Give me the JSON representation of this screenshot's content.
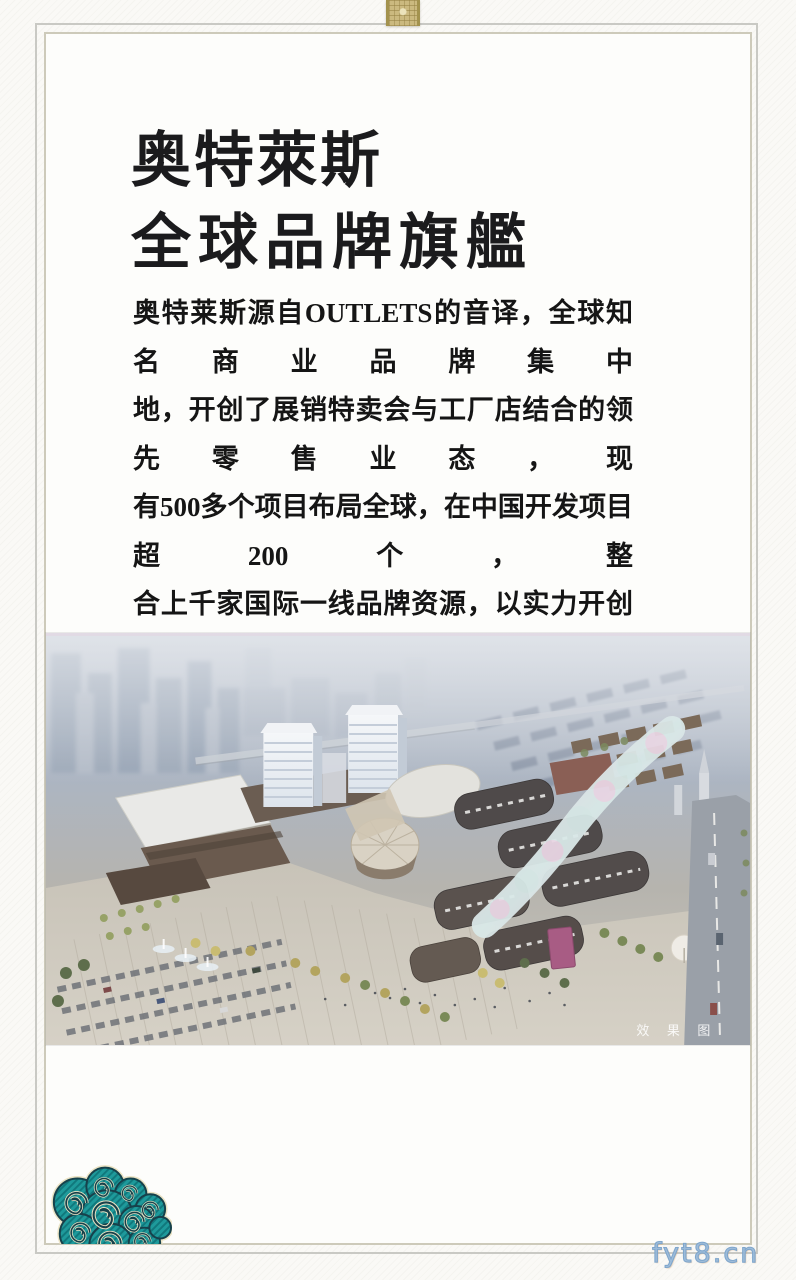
{
  "poster": {
    "title": {
      "line1": "奥特萊斯",
      "line2": "全球品牌旗艦"
    },
    "body": {
      "lines": [
        "奥特莱斯源自OUTLETS的音译，全球知名商业品牌集中",
        "地，开创了展销特卖会与工厂店结合的领先零售业态，现",
        "有500多个项目布局全球，在中国开发项目超200个，整",
        "合上千家国际一线品牌资源，以实力开创全球辉煌版图，",
        "以“世界名牌折扣店”、“工厂直销店”、“品牌直销广",
        "场”享誉全球。"
      ]
    },
    "photo": {
      "caption": "效 果 图"
    },
    "watermark": "fyt8.cn",
    "decorations": {
      "top_ornament": "gold-brocade-ribbon",
      "bottom_left": "teal-auspicious-cloud"
    },
    "colors": {
      "frame_outer": "#c9c9c4",
      "frame_inner": "#cdcaba",
      "title_text": "#1b1b1d",
      "body_text": "#151515",
      "ornament_gold": "#cbb97f",
      "cloud_teal": "#1e9a9b",
      "cloud_outline": "#17414b",
      "cloud_trim": "#ebe3c4",
      "watermark_blue": "#7fa6cc",
      "photo_sky": "#b4bdc9",
      "photo_roof_dark": "#4f4a4a",
      "photo_canopy_pink": "#eccede"
    }
  }
}
